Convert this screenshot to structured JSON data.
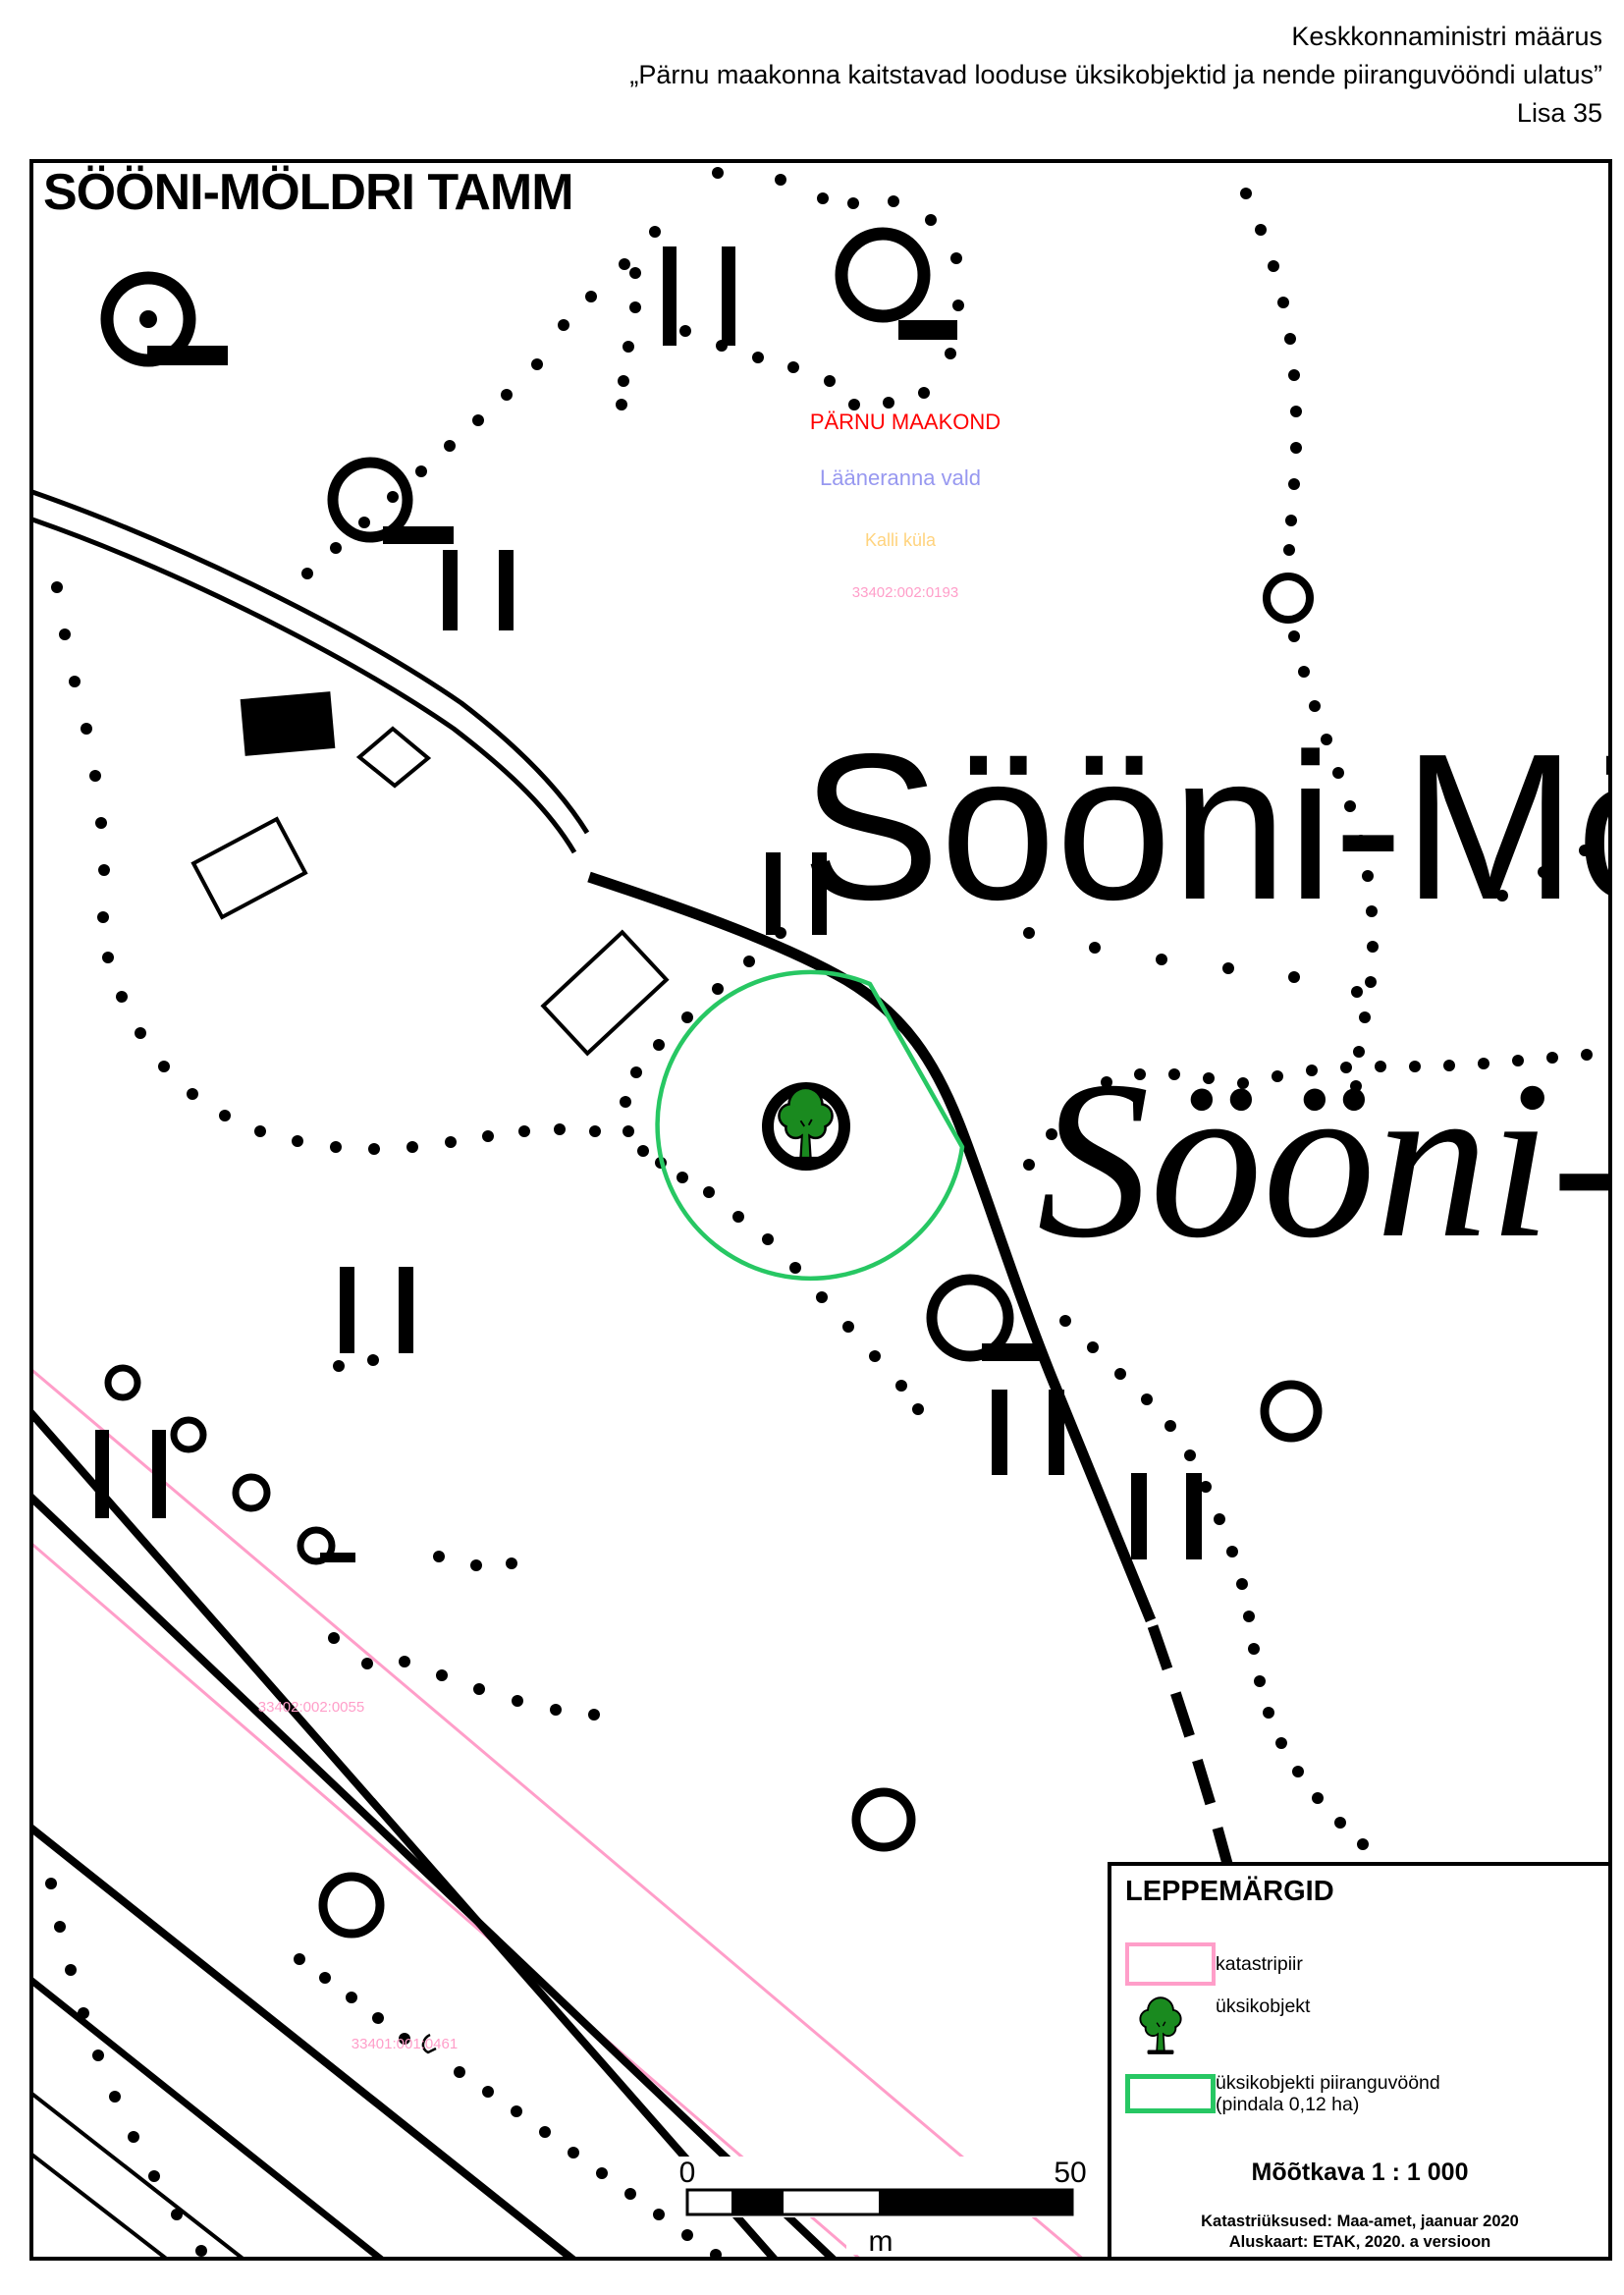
{
  "header": {
    "line1": "Keskkonnaministri määrus",
    "line2": "„Pärnu maakonna kaitstavad looduse üksikobjektid ja nende piiranguvööndi ulatus”",
    "line3": "Lisa 35"
  },
  "map": {
    "title": "SÖÖNI-MÖLDRI TAMM",
    "big_name": "Sööni-Mö",
    "big_name_italic": "Sööni-",
    "labels": {
      "county": "PÄRNU MAAKOND",
      "municipality": "Lääneranna vald",
      "village": "Kalli küla",
      "cadastral_center": "33402:002:0193",
      "cadastral_sw1": "33402:002:0055",
      "cadastral_sw2": "33401:001:0461"
    },
    "scalebar": {
      "start": "0",
      "end": "50",
      "unit": "m"
    }
  },
  "legend": {
    "title": "LEPPEMÄRGID",
    "items": [
      {
        "symbol": "cadastral-boundary-swatch",
        "label": "katastripiir"
      },
      {
        "symbol": "single-object-tree",
        "label": "üksikobjekt"
      },
      {
        "symbol": "protection-zone-swatch",
        "label": "üksikobjekti piiranguvöönd",
        "label2": "(pindala 0,12 ha)"
      }
    ],
    "scale_text": "Mõõtkava 1 : 1 000",
    "source_line1": "Katastriüksused: Maa-amet, jaanuar 2020",
    "source_line2": "Aluskaart: ETAK, 2020. a versioon"
  },
  "colors": {
    "boundary_pink": "#ff9ec9",
    "zone_green": "#27c763",
    "tree_green": "#1a8a1f",
    "county_red": "#ff0000",
    "municipality_blue": "#9798f0",
    "village_orange": "#ffd37e"
  }
}
